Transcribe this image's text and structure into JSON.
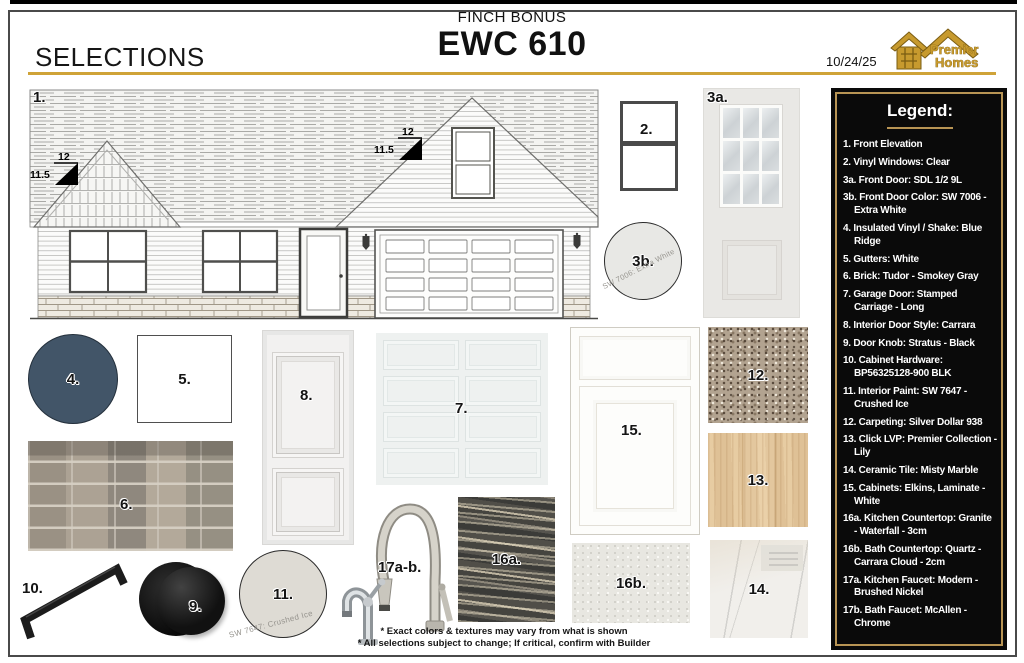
{
  "header": {
    "selections_label": "SELECTIONS",
    "community": "FINCH BONUS",
    "model": "EWC 610",
    "date": "10/24/25"
  },
  "logo": {
    "line1": "Premier",
    "line2": "Homes"
  },
  "legend": {
    "title": "Legend:",
    "items": [
      "1. Front Elevation",
      "2. Vinyl Windows: Clear",
      "3a. Front Door: SDL 1/2 9L",
      "3b. Front Door Color: SW 7006 - Extra White",
      "4. Insulated Vinyl / Shake: Blue Ridge",
      "5. Gutters: White",
      "6. Brick: Tudor - Smokey Gray",
      "7. Garage Door: Stamped Carriage - Long",
      "8. Interior Door Style: Carrara",
      "9. Door Knob: Stratus - Black",
      "10. Cabinet Hardware: BP56325128-900 BLK",
      "11. Interior Paint: SW 7647 - Crushed Ice",
      "12. Carpeting: Silver Dollar 938",
      "13. Click LVP: Premier Collection - Lily",
      "14. Ceramic Tile: Misty Marble",
      "15. Cabinets: Elkins, Laminate - White",
      "16a. Kitchen Countertop: Granite - Waterfall - 3cm",
      "16b. Bath Countertop: Quartz - Carrara Cloud - 2cm",
      "17a. Kitchen Faucet: Modern - Brushed Nickel",
      "17b. Bath Faucet: McAllen - Chrome"
    ]
  },
  "labels": {
    "elevation": "1.",
    "window": "2.",
    "front_door": "3a.",
    "front_door_color": "3b.",
    "vinyl_shake": "4.",
    "gutters": "5.",
    "brick": "6.",
    "garage_door": "7.",
    "interior_door": "8.",
    "door_knob": "9.",
    "cabinet_hardware": "10.",
    "interior_paint": "11.",
    "carpet": "12.",
    "lvp": "13.",
    "tile": "14.",
    "cabinets": "15.",
    "kitchen_countertop": "16a.",
    "bath_countertop": "16b.",
    "faucets": "17a-b."
  },
  "captions": {
    "front_door_color": "SW 7006: Extra White",
    "interior_paint": "SW 7647: Crushed Ice"
  },
  "elevation": {
    "pitch_rise": "12",
    "pitch_run": "11.5"
  },
  "notes": [
    "* Exact colors & textures may vary from what is shown",
    "* All selections subject to change; If critical, confirm with Builder"
  ],
  "colors": {
    "accent_gold": "#cfa338",
    "legend_background": "#0a0a0a",
    "legend_border": "#b89454",
    "blue_ridge_vinyl": "#425568",
    "extra_white_paint": "#e8e8e5",
    "crushed_ice_paint": "#dedbd4"
  }
}
